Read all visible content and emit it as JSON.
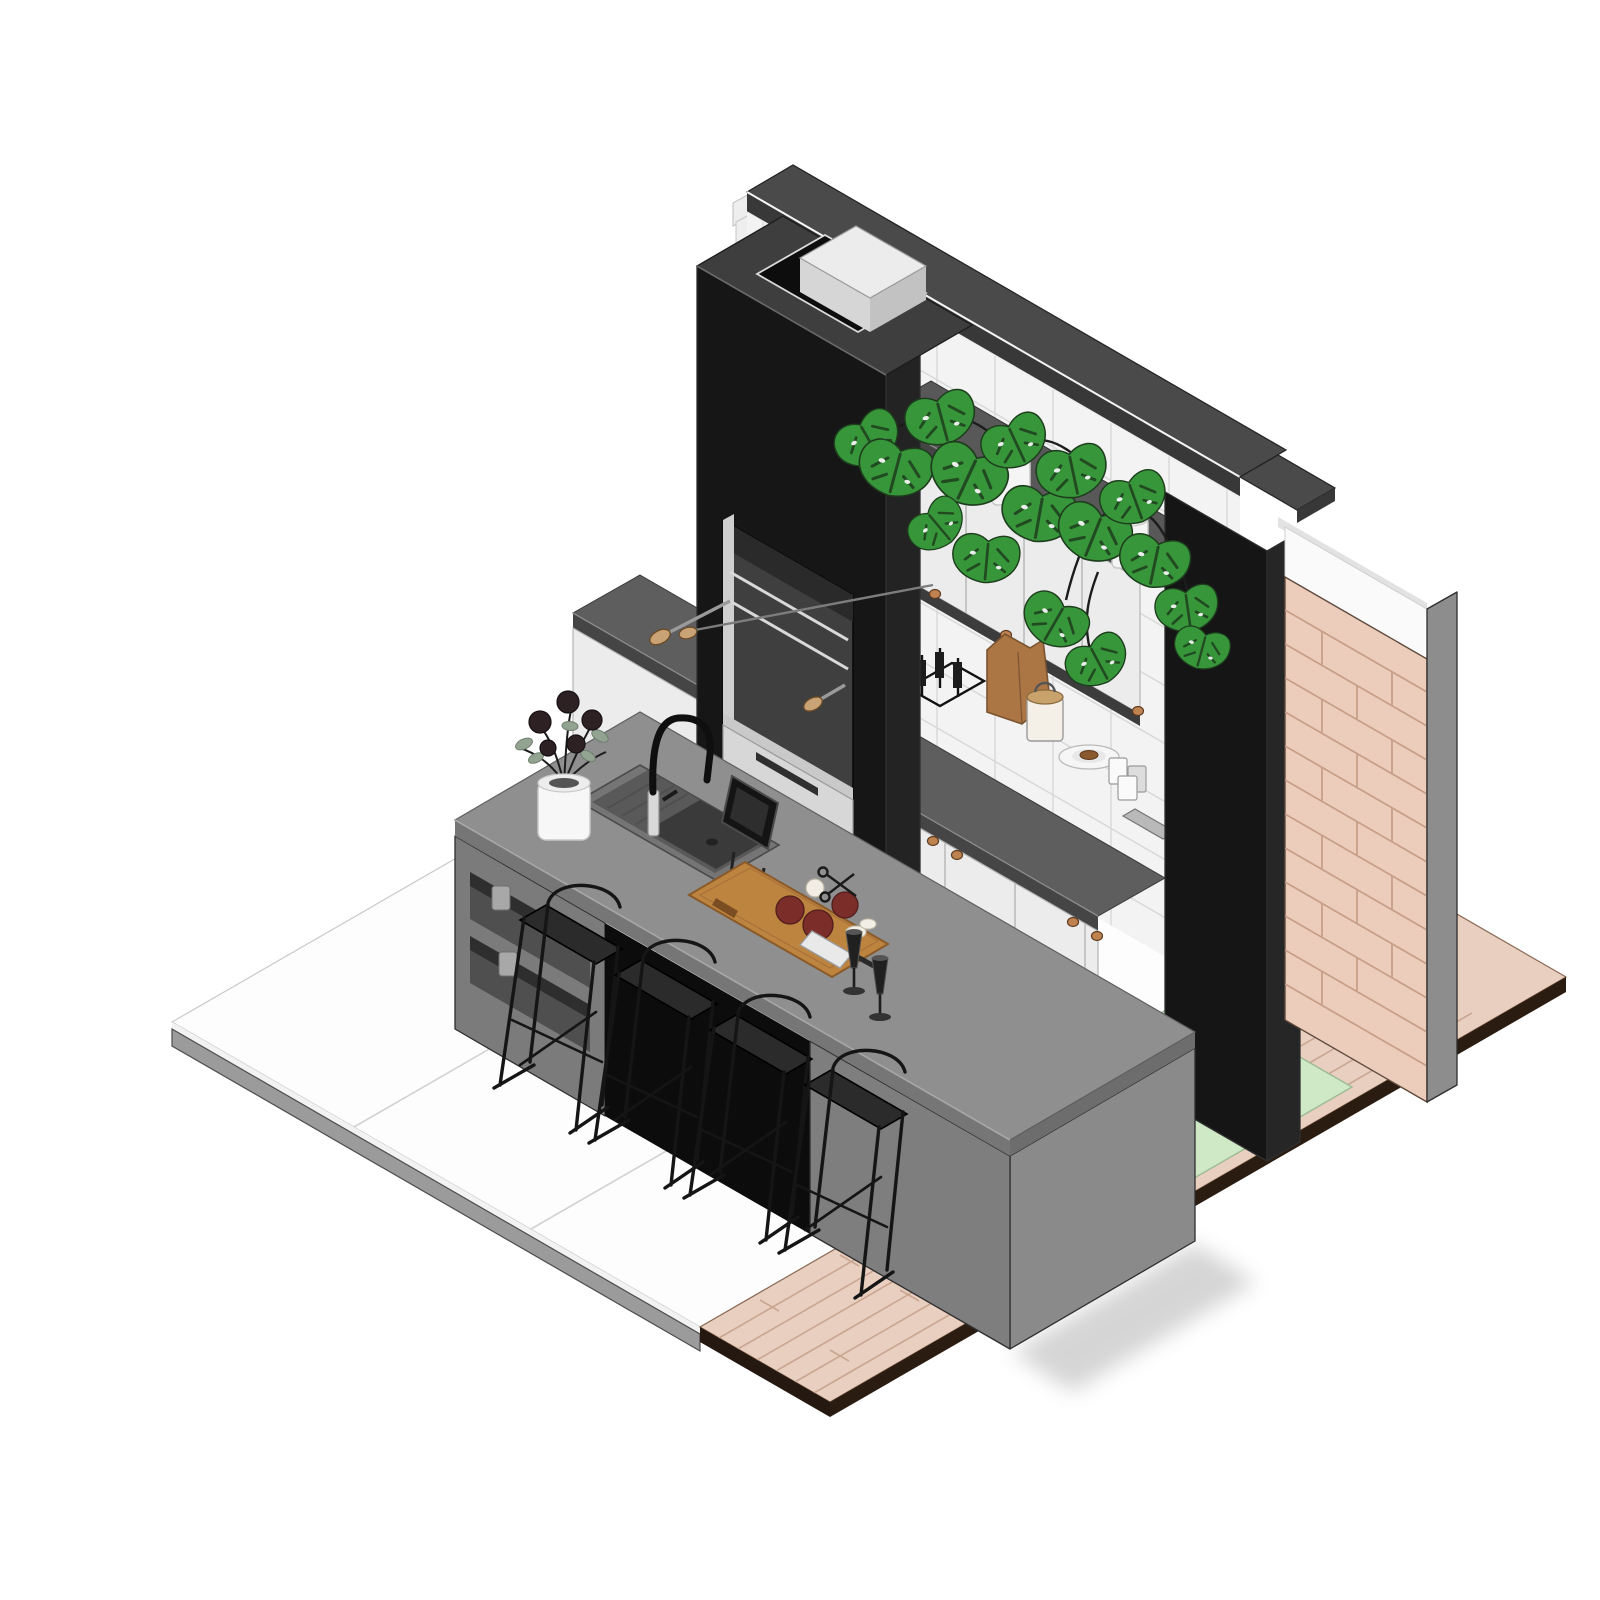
{
  "scene": {
    "type": "isometric-architectural-render",
    "subject": "outdoor barbecue kitchen with grill tower, tiled wall, cabinetry, island and bar stools",
    "view": "axonometric-30deg",
    "background": "#ffffff",
    "colors": {
      "bg": "#ffffff",
      "outline": "#2e2e2e",
      "towerFront": "#161616",
      "towerSide": "#232323",
      "towerTop": "#3e3e3e",
      "capTop": "#4a4a4a",
      "capFace": "#383838",
      "capHighlight": "#f5f5f5",
      "tile": "#f3f3f3",
      "grout": "#d9d9d9",
      "wallSliver": "#eeeeee",
      "shelfTop": "#585858",
      "shelfFace": "#454545",
      "doorWhite": "#ececec",
      "doorLine": "#b5b5b5",
      "underBand": "#3c3c3c",
      "counterTop": "#5e5e5e",
      "counterFace": "#454545",
      "toe": "#1c1c1c",
      "knob": "#bf8352",
      "knobStroke": "#5d3a1f",
      "pillarFront": "#151515",
      "pillarSide": "#262626",
      "whiteBand": "#fafafa",
      "whiteCap": "#e2e2e2",
      "brick": "#eccdbb",
      "brickJoint": "#c79f89",
      "wallEdge": "#8d8d8d",
      "floor": "#fdfdfd",
      "floorJoint": "#d2d2d2",
      "slabBand": "#9b9b9b",
      "slabTop": "#f2f2f2",
      "deck": "#e9cfbf",
      "deckJoint": "#c9a692",
      "deckFascia": "#2b1c12",
      "mat": "#cfe8c5",
      "matEdge": "#9dbb93",
      "openInner": "#3f3f3f",
      "openShadow": "#2a2a2a",
      "openJamb": "#cfcfcf",
      "sill": "#c9c9c9",
      "drawer": "#d7d7d7",
      "slot": "#2f2f2f",
      "rail": "#d9d9d9",
      "woodHandle": "#c9a275",
      "capBoxTop": "#ececec",
      "capBoxFront": "#d6d6d6",
      "capBoxSide": "#c2c2c2",
      "nicheLower": "#5f5f5f",
      "islandTop": "#8f8f8f",
      "islandFascia": "#767676",
      "islandFasciaSide": "#6d6d6d",
      "islandFront": "#7b7b7b",
      "islandSide": "#8a8a8a",
      "islandLeg": "#7e7e7e",
      "niche": "#0c0c0c",
      "cubby": "#4f4f4f",
      "cubbyShadow": "#2e2e2e",
      "jar": "#a8a8a8",
      "sinkRim": "#757575",
      "sinkInner": "#595959",
      "basin": "#3a3a3a",
      "faucetBlack": "#0f0f0f",
      "chrome": "#d8d8d8",
      "vase": "#f7f7f7",
      "vaseInner": "#555555",
      "flowerDark": "#2e2124",
      "eucalyptus": "#93a391",
      "leafGreen": "#37953a",
      "leafDark": "#2c7c30",
      "plantDark": "#1d3d1d",
      "stemDark": "#1c1c1c",
      "pot": "#f5f5f5",
      "potShade": "#c9c9c9",
      "board": "#bd8440",
      "boardEdge": "#8a5a28",
      "tomato": "#7b2d2a",
      "tomatoDark": "#511d1b",
      "garlic": "#f1ede4",
      "onion": "#f3efe6",
      "blade": "#e9e9e9",
      "handleDark": "#2a2a2a",
      "flute": "#202020",
      "bag": "#ab7544",
      "bagEdge": "#7a5430",
      "canister": "#f4efe7",
      "lid": "#c9a16b",
      "plate": "#f6f6f6",
      "plateEdge": "#bbbbbb",
      "food": "#8a5a2e",
      "cup": "#fafafa",
      "cupShade": "#dddddd",
      "tray": "#b9b9b9",
      "rack": "#111111",
      "stool": "#151515",
      "seat": "#2b2b2b",
      "shadow": "#6b6b6b"
    },
    "objects": [
      {
        "name": "grill-tower",
        "finish": "black"
      },
      {
        "name": "chimney-cap",
        "finish": "light-gray"
      },
      {
        "name": "tiled-back-wall",
        "finish": "white-square-tile"
      },
      {
        "name": "plant-shelf",
        "plants": "monstera-in-white-pots"
      },
      {
        "name": "upper-cabinets",
        "doors": 4,
        "hardware": "copper-knobs"
      },
      {
        "name": "base-cabinets",
        "doors": 4,
        "hardware": "copper-knobs"
      },
      {
        "name": "countertop-items",
        "items": [
          "bottle-rack",
          "paper-bag",
          "canister",
          "plate-with-food",
          "cups",
          "tray"
        ]
      },
      {
        "name": "right-end-pillar",
        "finish": "black"
      },
      {
        "name": "brick-side-wall",
        "finish": "pink-brick"
      },
      {
        "name": "kitchen-island",
        "features": [
          "sink",
          "black-faucet",
          "open-cubbies",
          "waterfall-side"
        ]
      },
      {
        "name": "island-items",
        "items": [
          "vase-with-flowers",
          "tablet-on-stand",
          "cutting-board-with-food",
          "champagne-flutes"
        ]
      },
      {
        "name": "bar-stools",
        "count": 4,
        "style": "black-wire-frame"
      },
      {
        "name": "white-tile-floor"
      },
      {
        "name": "wood-deck"
      },
      {
        "name": "green-mat"
      }
    ]
  }
}
